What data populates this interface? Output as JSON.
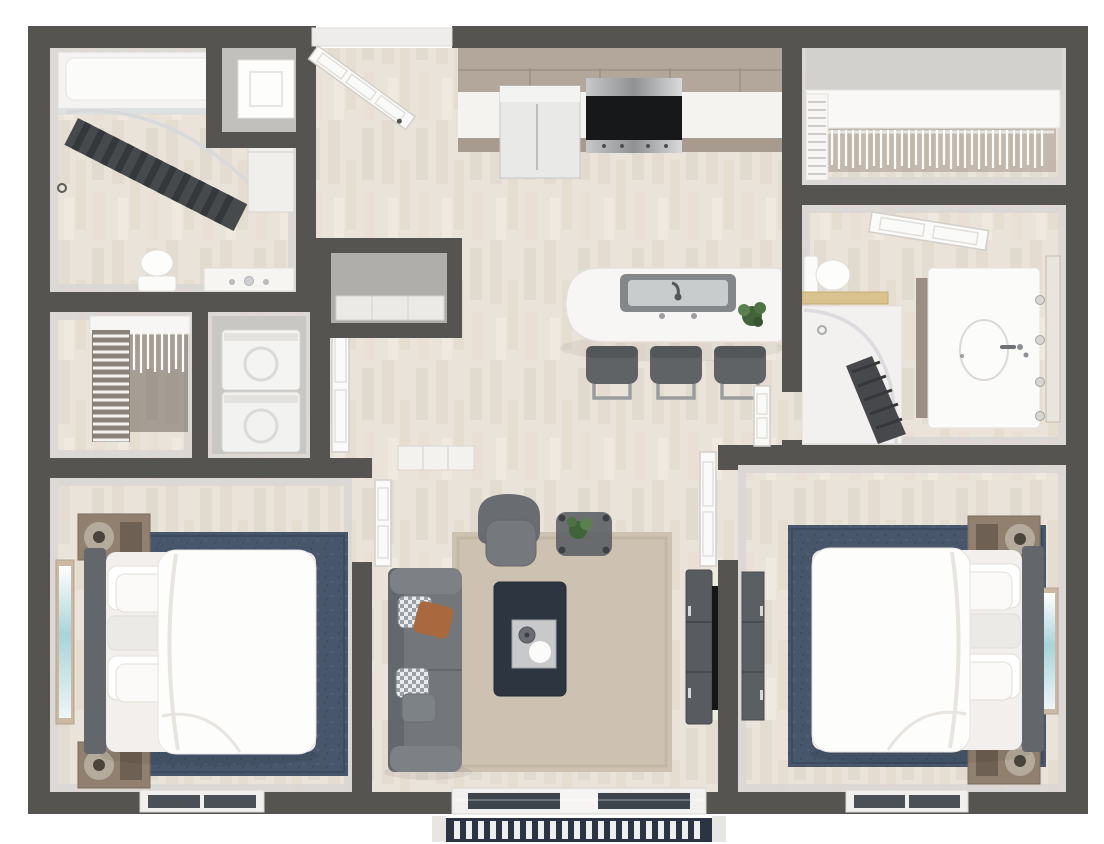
{
  "scene": {
    "type": "floor-plan-3d-render",
    "view": "top-down bird's-eye",
    "label": "2 Bedroom 2 Bathroom Apartment 3D Floor Plan"
  },
  "palette": {
    "wall": "#555450",
    "wall_face_light": "#d9d6d3",
    "floor_wood": "#eae3da",
    "floor_wood_streak": "#ddd3c7",
    "rug_navy": "#47566b",
    "rug_beige": "#cdc2b2",
    "sofa_gray": "#73767a",
    "coffee_table_dark": "#2d3541",
    "cabinet_taupe": "#b3a79c",
    "counter_white": "#f4f3f0",
    "appliance_black": "#17181a",
    "stainless": "#a8a9ab",
    "nightstand_brown": "#91806f",
    "lamp_tan": "#b5ab9c",
    "curtain_dark": "#474a4c",
    "towel_shelf_tan": "#d9c28e",
    "art_teal": "#a8d4da",
    "pillow_rust": "#a9683d",
    "deck_slat_white": "#eef0ef",
    "deck_base_navy": "#2b3442"
  },
  "counts": {
    "bedrooms": 2,
    "bathrooms": 2,
    "bar_stools": 3,
    "closets": 4
  },
  "rooms": [
    {
      "id": "bathroom-1",
      "label": "Bathroom 1",
      "items": [
        "bathtub-shower",
        "shower-curtain",
        "curtain-rod",
        "toilet",
        "vanity-sink",
        "linen-cabinet"
      ]
    },
    {
      "id": "utility-closet",
      "label": "Utility Closet",
      "items": [
        "water-heater"
      ]
    },
    {
      "id": "entry",
      "label": "Entry",
      "items": [
        "entry-door"
      ]
    },
    {
      "id": "kitchen",
      "label": "Kitchen",
      "items": [
        "upper-cabinets",
        "countertop",
        "refrigerator",
        "range",
        "range-hood",
        "island",
        "island-sink",
        "faucet",
        "plant",
        "bar-stool",
        "bar-stool",
        "bar-stool"
      ]
    },
    {
      "id": "walk-in-closet",
      "label": "Walk-in Closet",
      "items": [
        "closet-shelf",
        "hanging-rod",
        "hangers",
        "side-shelving"
      ]
    },
    {
      "id": "bathroom-2",
      "label": "Bathroom 2",
      "items": [
        "door",
        "toilet",
        "towel-shelf",
        "shower",
        "shower-curtain",
        "curtain-rod",
        "vanity-sink",
        "mirror",
        "wall-knobs"
      ]
    },
    {
      "id": "bedroom-1-closet",
      "label": "Bedroom 1 Closet",
      "items": [
        "wire-shelves",
        "hangers",
        "closet-shelf"
      ]
    },
    {
      "id": "laundry-closet",
      "label": "Laundry Closet",
      "items": [
        "stacked-washer-dryer",
        "door"
      ]
    },
    {
      "id": "coat-closet",
      "label": "Coat Closet",
      "items": [
        "door"
      ]
    },
    {
      "id": "bedroom-1",
      "label": "Bedroom 1",
      "items": [
        "bed",
        "headboard",
        "pillows",
        "duvet",
        "area-rug",
        "nightstand",
        "nightstand",
        "table-lamp",
        "table-lamp",
        "wall-art",
        "window",
        "closet-doors",
        "door"
      ]
    },
    {
      "id": "living-room",
      "label": "Living Room",
      "items": [
        "sofa",
        "throw-pillows",
        "coffee-table",
        "serving-tray",
        "armchair",
        "side-table",
        "plant",
        "tv-console",
        "tv",
        "area-rug",
        "sliding-patio-door",
        "console-table"
      ]
    },
    {
      "id": "bedroom-2",
      "label": "Bedroom 2",
      "items": [
        "bed",
        "headboard",
        "pillows",
        "duvet",
        "area-rug",
        "nightstand",
        "nightstand",
        "table-lamp",
        "table-lamp",
        "wall-art",
        "window",
        "dresser",
        "door"
      ]
    },
    {
      "id": "balcony",
      "label": "Balcony",
      "items": [
        "slatted-deck"
      ]
    }
  ]
}
